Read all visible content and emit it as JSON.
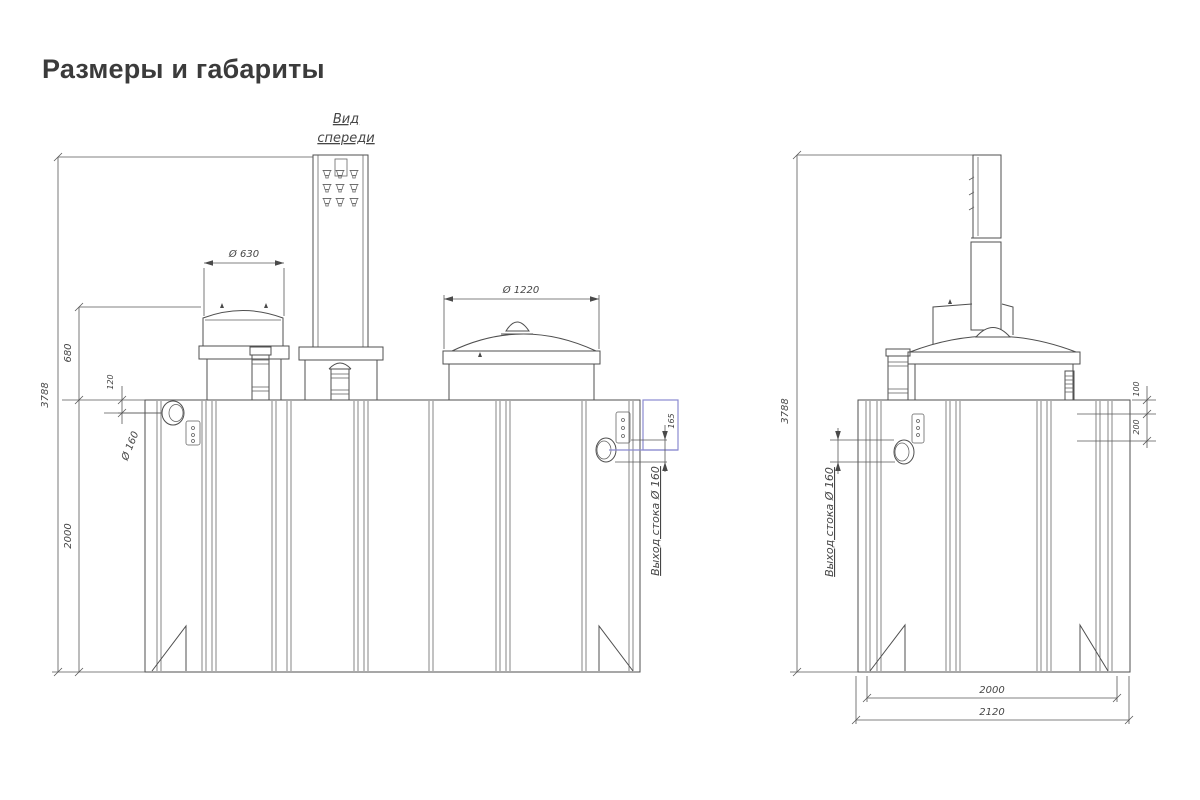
{
  "title": "Размеры и габариты",
  "front_view": {
    "label_line1": "Вид",
    "label_line2": "спереди",
    "dims": {
      "overall_height": "3788",
      "body_height": "2000",
      "neck_height": "680",
      "inlet_depth": "120",
      "inlet_diameter": "Ø 160",
      "hatch_diameter": "Ø 630",
      "dome_diameter": "Ø 1220",
      "outlet_depth": "165",
      "outlet_label": "Выход стока Ø 160"
    }
  },
  "side_view": {
    "dims": {
      "overall_height": "3788",
      "outlet_top_offset": "100",
      "outlet_span": "200",
      "outlet_label": "Выход стока Ø 160",
      "body_width": "2000",
      "overall_width": "2120"
    }
  },
  "colors": {
    "line": "#4f4f4f",
    "highlight": "#8a8ad0",
    "title_text": "#3b3b3b",
    "dim_text": "#464646"
  }
}
